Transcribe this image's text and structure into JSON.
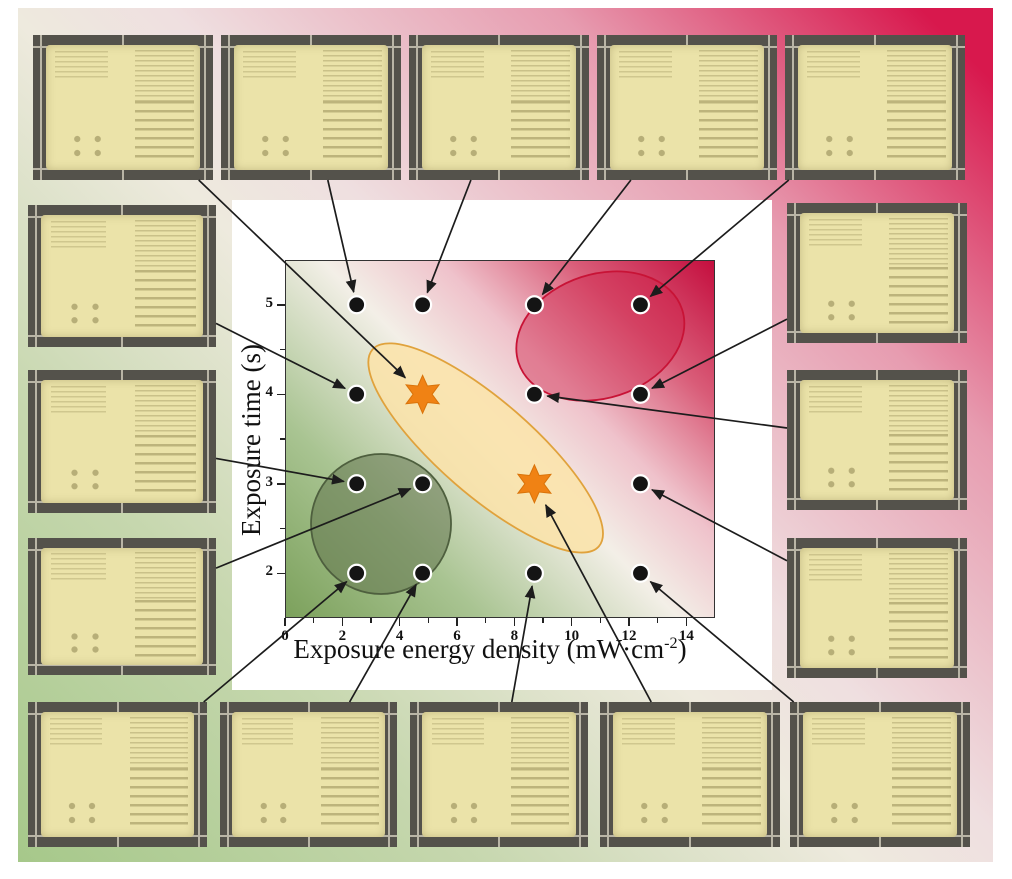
{
  "chart_data": {
    "type": "scatter",
    "xlabel": {
      "main": "Exposure energy density (mW·cm",
      "sup": "-2",
      "end": ")"
    },
    "ylabel": "Exposure time (s)",
    "x_major_ticks": [
      0,
      2,
      4,
      6,
      8,
      10,
      12,
      14
    ],
    "x_minor_ticks": [
      1,
      3,
      5,
      7,
      9,
      11,
      13
    ],
    "y_major_ticks": [
      2,
      3,
      4,
      5
    ],
    "y_minor_ticks": [
      2.5,
      3.5,
      4.5
    ],
    "xlim": [
      0,
      15
    ],
    "ylim": [
      1.5,
      5.5
    ],
    "grid": false,
    "legend": "none",
    "points": [
      {
        "x": 2.5,
        "y": 5,
        "marker": "dot"
      },
      {
        "x": 4.8,
        "y": 5,
        "marker": "dot"
      },
      {
        "x": 8.7,
        "y": 5,
        "marker": "dot"
      },
      {
        "x": 12.4,
        "y": 5,
        "marker": "dot"
      },
      {
        "x": 2.5,
        "y": 4,
        "marker": "dot"
      },
      {
        "x": 4.8,
        "y": 4,
        "marker": "star"
      },
      {
        "x": 8.7,
        "y": 4,
        "marker": "dot"
      },
      {
        "x": 12.4,
        "y": 4,
        "marker": "dot"
      },
      {
        "x": 2.5,
        "y": 3,
        "marker": "dot"
      },
      {
        "x": 4.8,
        "y": 3,
        "marker": "dot"
      },
      {
        "x": 8.7,
        "y": 3,
        "marker": "star"
      },
      {
        "x": 12.4,
        "y": 3,
        "marker": "dot"
      },
      {
        "x": 2.5,
        "y": 2,
        "marker": "dot"
      },
      {
        "x": 4.8,
        "y": 2,
        "marker": "dot"
      },
      {
        "x": 8.7,
        "y": 2,
        "marker": "dot"
      },
      {
        "x": 12.4,
        "y": 2,
        "marker": "dot"
      }
    ],
    "regions": [
      {
        "name": "green-circle",
        "cx": 3.35,
        "cy": 2.55,
        "rx_px": 70,
        "ry_px": 70,
        "angle_deg": 0,
        "fill": "rgba(96,114,76,0.55)",
        "stroke": "#4e5f3e"
      },
      {
        "name": "orange-ellipse",
        "cx": 7.0,
        "cy": 3.4,
        "rx_px": 150,
        "ry_px": 47,
        "angle_deg": 41,
        "fill": "rgba(250,227,170,0.88)",
        "stroke": "#e0a23c"
      },
      {
        "name": "red-ellipse",
        "cx": 11.0,
        "cy": 4.65,
        "rx_px": 86,
        "ry_px": 62,
        "angle_deg": -18,
        "fill": "rgba(206,28,68,0.42)",
        "stroke": "#c81336"
      }
    ],
    "marker_style": {
      "dot_color": "#141414",
      "dot_ring": "#ffffff",
      "star_color": "#f08214",
      "star_edge": "#d9730a"
    },
    "plot_bg_gradient": [
      "#7ca15c",
      "#f3efe7",
      "#c40e3e"
    ]
  },
  "background": {
    "outer_gradient": [
      "#a6c88a",
      "#eeeade",
      "#d8184d"
    ],
    "margin_color": "#ffffff"
  },
  "arrows": {
    "color": "#1c1c1c"
  },
  "photos": [
    {
      "id": "top-1",
      "position": "top row 1",
      "links_to": {
        "x": 4.8,
        "y": 4
      }
    },
    {
      "id": "top-2",
      "position": "top row 2",
      "links_to": {
        "x": 2.5,
        "y": 5
      }
    },
    {
      "id": "top-3",
      "position": "top row 3",
      "links_to": {
        "x": 4.8,
        "y": 5
      }
    },
    {
      "id": "top-4",
      "position": "top row 4",
      "links_to": {
        "x": 8.7,
        "y": 5
      }
    },
    {
      "id": "top-5",
      "position": "top row 5",
      "links_to": {
        "x": 12.4,
        "y": 5
      }
    },
    {
      "id": "left-1",
      "position": "left column 1",
      "links_to": {
        "x": 2.5,
        "y": 4
      }
    },
    {
      "id": "left-2",
      "position": "left column 2",
      "links_to": {
        "x": 2.5,
        "y": 3
      }
    },
    {
      "id": "left-3",
      "position": "left column 3",
      "links_to": {
        "x": 4.8,
        "y": 3
      }
    },
    {
      "id": "right-1",
      "position": "right column 1",
      "links_to": {
        "x": 12.4,
        "y": 4
      }
    },
    {
      "id": "right-2",
      "position": "right column 2",
      "links_to": {
        "x": 8.7,
        "y": 4
      }
    },
    {
      "id": "right-3",
      "position": "right column 3",
      "links_to": {
        "x": 12.4,
        "y": 3
      }
    },
    {
      "id": "bottom-1",
      "position": "bottom row 1",
      "links_to": {
        "x": 2.5,
        "y": 2
      }
    },
    {
      "id": "bottom-2",
      "position": "bottom row 2",
      "links_to": {
        "x": 4.8,
        "y": 2
      }
    },
    {
      "id": "bottom-3",
      "position": "bottom row 3",
      "links_to": {
        "x": 8.7,
        "y": 2
      }
    },
    {
      "id": "bottom-4",
      "position": "bottom row 4",
      "links_to": {
        "x": 8.7,
        "y": 3
      }
    },
    {
      "id": "bottom-5",
      "position": "bottom row 5",
      "links_to": {
        "x": 12.4,
        "y": 2
      }
    }
  ]
}
